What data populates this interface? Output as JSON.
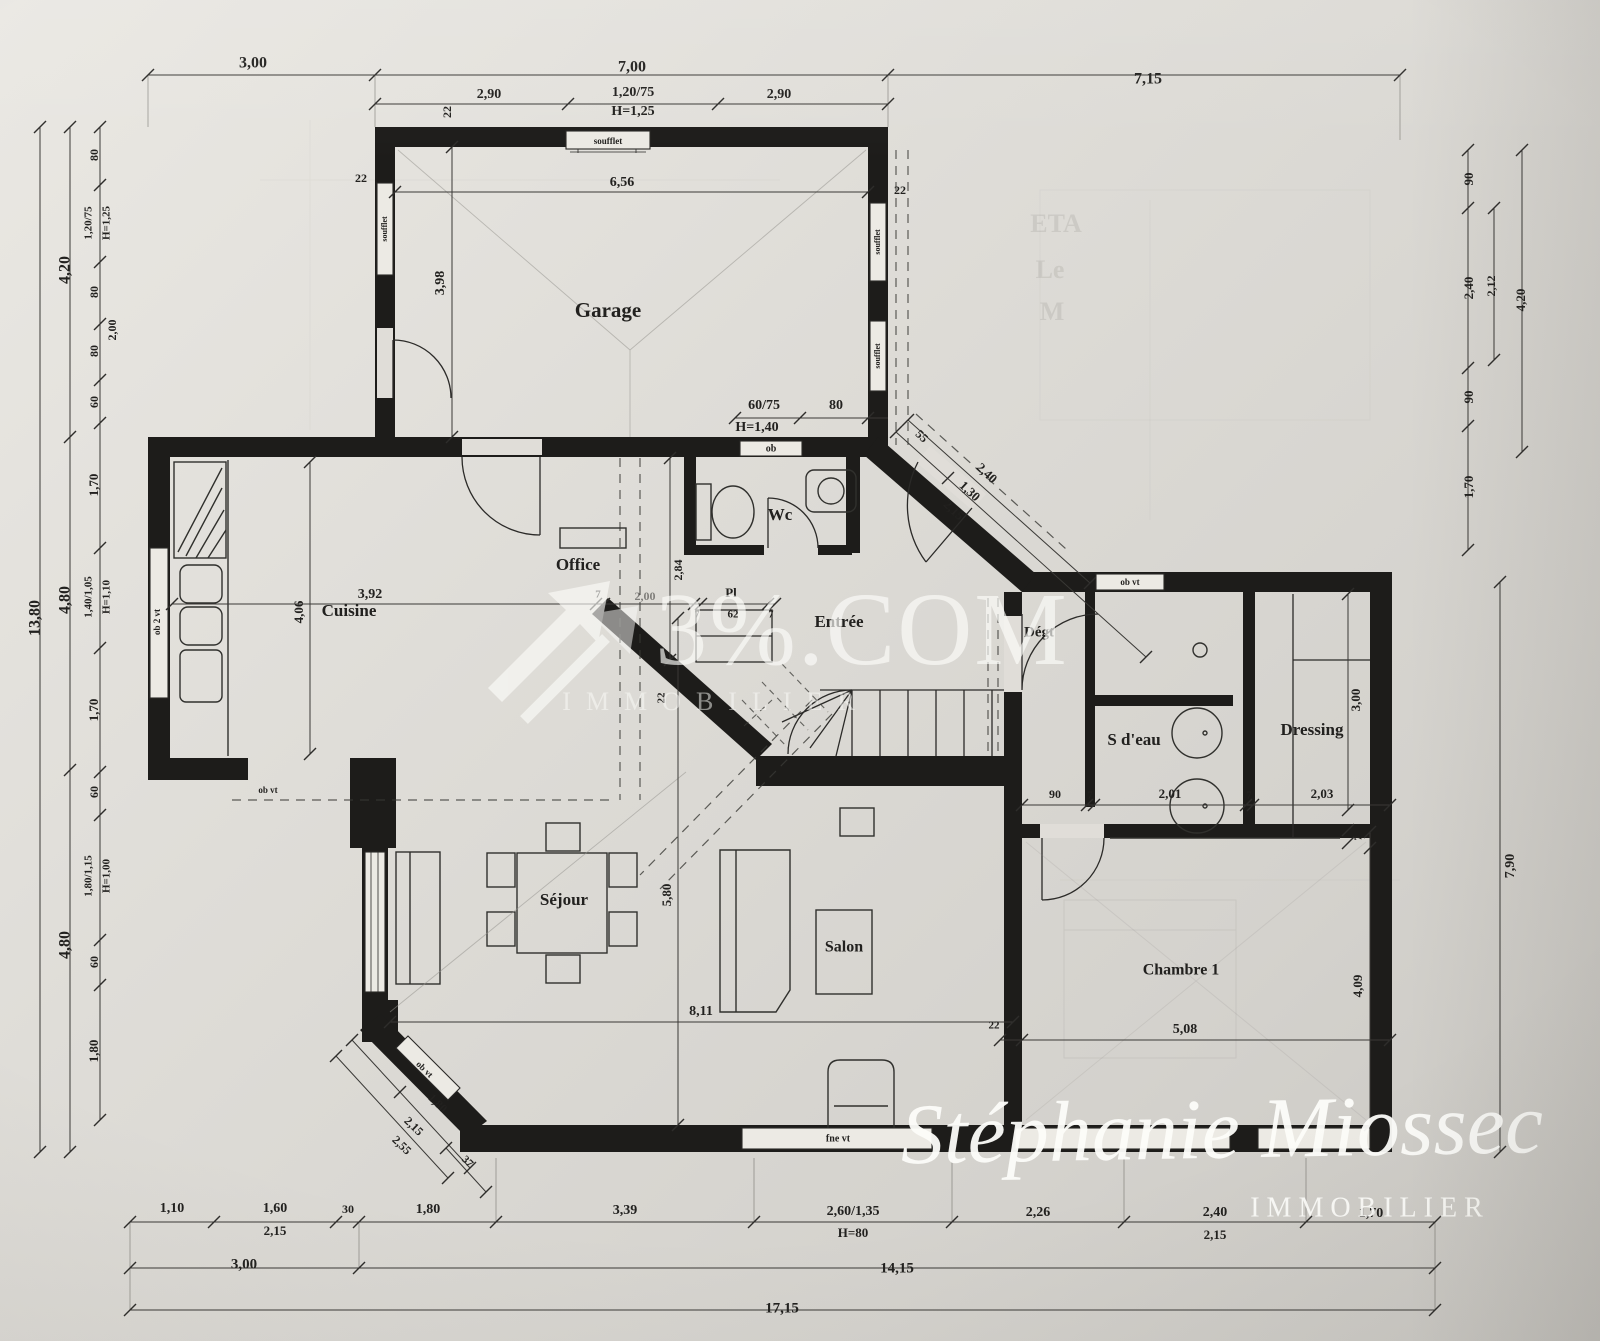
{
  "document": {
    "type": "architectural floor plan",
    "language": "fr"
  },
  "watermark": {
    "brand": "3%.COM",
    "brand_tagline": "IMMOBILIER",
    "brand_logo": "diagonal-arrows-logo",
    "agency": "Stéphanie Miossec",
    "agency_tagline": "IMMOBILIER"
  },
  "labels": {
    "rooms": [
      {
        "t": "Garage",
        "x": 608,
        "y": 312,
        "s": 21
      },
      {
        "t": "Office",
        "x": 578,
        "y": 566,
        "s": 17
      },
      {
        "t": "Cuisine",
        "x": 349,
        "y": 612,
        "s": 17
      },
      {
        "t": "Wc",
        "x": 780,
        "y": 516,
        "s": 17
      },
      {
        "t": "Entrée",
        "x": 839,
        "y": 623,
        "s": 17
      },
      {
        "t": "Dégt",
        "x": 1039,
        "y": 633,
        "s": 15
      },
      {
        "t": "Pl",
        "x": 731,
        "y": 594,
        "s": 13
      },
      {
        "t": "S d'eau",
        "x": 1134,
        "y": 741,
        "s": 17
      },
      {
        "t": "Dressing",
        "x": 1312,
        "y": 731,
        "s": 17
      },
      {
        "t": "Séjour",
        "x": 564,
        "y": 901,
        "s": 17
      },
      {
        "t": "Salon",
        "x": 844,
        "y": 948,
        "s": 16
      },
      {
        "t": "Chambre 1",
        "x": 1181,
        "y": 971,
        "s": 16
      }
    ],
    "windows": [
      {
        "t": "soufflet",
        "x": 608,
        "y": 142,
        "s": 9
      },
      {
        "t": "soufflet",
        "x": 385,
        "y": 229,
        "r": -90,
        "s": 8
      },
      {
        "t": "soufflet",
        "x": 878,
        "y": 242,
        "r": -90,
        "s": 8
      },
      {
        "t": "soufflet",
        "x": 878,
        "y": 356,
        "r": -90,
        "s": 8
      },
      {
        "t": "ob",
        "x": 771,
        "y": 449,
        "s": 10
      },
      {
        "t": "ob vt",
        "x": 1130,
        "y": 583,
        "s": 9
      },
      {
        "t": "ob vt",
        "x": 268,
        "y": 791,
        "s": 9
      },
      {
        "t": "ob 2 vt",
        "x": 158,
        "y": 622,
        "r": -90,
        "s": 9
      },
      {
        "t": "fne vt",
        "x": 838,
        "y": 1139,
        "s": 10
      },
      {
        "t": "ob vt",
        "x": 424,
        "y": 1070,
        "r": 44,
        "s": 9
      }
    ],
    "dims": [
      {
        "t": "3,00",
        "x": 253,
        "y": 64,
        "s": 16
      },
      {
        "t": "7,00",
        "x": 632,
        "y": 68,
        "s": 16
      },
      {
        "t": "7,15",
        "x": 1148,
        "y": 80,
        "s": 16
      },
      {
        "t": "2,90",
        "x": 489,
        "y": 95,
        "s": 14
      },
      {
        "t": "1,20/75",
        "x": 633,
        "y": 93,
        "s": 14
      },
      {
        "t": "H=1,25",
        "x": 633,
        "y": 112,
        "s": 14
      },
      {
        "t": "2,90",
        "x": 779,
        "y": 95,
        "s": 14
      },
      {
        "t": "22",
        "x": 448,
        "y": 112,
        "r": -90,
        "s": 12
      },
      {
        "t": "22",
        "x": 361,
        "y": 179,
        "s": 12
      },
      {
        "t": "6,56",
        "x": 622,
        "y": 183,
        "s": 14
      },
      {
        "t": "22",
        "x": 900,
        "y": 191,
        "s": 12
      },
      {
        "t": "3,98",
        "x": 441,
        "y": 283,
        "r": -90,
        "s": 14
      },
      {
        "t": "60/75",
        "x": 764,
        "y": 406,
        "s": 14
      },
      {
        "t": "H=1,40",
        "x": 757,
        "y": 428,
        "s": 14
      },
      {
        "t": "80",
        "x": 836,
        "y": 406,
        "s": 14
      },
      {
        "t": "55",
        "x": 921,
        "y": 437,
        "r": 43,
        "s": 12
      },
      {
        "t": "2,40",
        "x": 986,
        "y": 474,
        "r": 43,
        "s": 13
      },
      {
        "t": "1,30",
        "x": 969,
        "y": 492,
        "r": 43,
        "s": 13
      },
      {
        "t": "2,15",
        "x": 953,
        "y": 511,
        "r": 43,
        "s": 13
      },
      {
        "t": "13,80",
        "x": 36,
        "y": 618,
        "r": -90,
        "s": 16
      },
      {
        "t": "4,20",
        "x": 66,
        "y": 270,
        "r": -90,
        "s": 16
      },
      {
        "t": "4,80",
        "x": 66,
        "y": 600,
        "r": -90,
        "s": 16
      },
      {
        "t": "4,80",
        "x": 66,
        "y": 945,
        "r": -90,
        "s": 16
      },
      {
        "t": "80",
        "x": 95,
        "y": 155,
        "r": -90,
        "s": 12
      },
      {
        "t": "1,20/75",
        "x": 89,
        "y": 223,
        "r": -90,
        "s": 11
      },
      {
        "t": "H=1,25",
        "x": 107,
        "y": 223,
        "r": -90,
        "s": 11
      },
      {
        "t": "80",
        "x": 95,
        "y": 292,
        "r": -90,
        "s": 12
      },
      {
        "t": "80",
        "x": 95,
        "y": 351,
        "r": -90,
        "s": 12
      },
      {
        "t": "2,00",
        "x": 113,
        "y": 330,
        "r": -90,
        "s": 12
      },
      {
        "t": "60",
        "x": 95,
        "y": 402,
        "r": -90,
        "s": 12
      },
      {
        "t": "1,70",
        "x": 95,
        "y": 485,
        "r": -90,
        "s": 13
      },
      {
        "t": "1,40/1,05",
        "x": 89,
        "y": 597,
        "r": -90,
        "s": 11
      },
      {
        "t": "H=1,10",
        "x": 107,
        "y": 597,
        "r": -90,
        "s": 11
      },
      {
        "t": "1,70",
        "x": 95,
        "y": 710,
        "r": -90,
        "s": 13
      },
      {
        "t": "60",
        "x": 95,
        "y": 792,
        "r": -90,
        "s": 12
      },
      {
        "t": "1,80/1,15",
        "x": 89,
        "y": 876,
        "r": -90,
        "s": 11
      },
      {
        "t": "H=1,00",
        "x": 107,
        "y": 876,
        "r": -90,
        "s": 11
      },
      {
        "t": "60",
        "x": 95,
        "y": 962,
        "r": -90,
        "s": 12
      },
      {
        "t": "1,80",
        "x": 95,
        "y": 1051,
        "r": -90,
        "s": 13
      },
      {
        "t": "90",
        "x": 1470,
        "y": 179,
        "r": -90,
        "s": 13
      },
      {
        "t": "2,40",
        "x": 1470,
        "y": 288,
        "r": -90,
        "s": 13
      },
      {
        "t": "2,12",
        "x": 1492,
        "y": 286,
        "r": -90,
        "s": 12
      },
      {
        "t": "4,20",
        "x": 1522,
        "y": 300,
        "r": -90,
        "s": 13
      },
      {
        "t": "90",
        "x": 1470,
        "y": 397,
        "r": -90,
        "s": 13
      },
      {
        "t": "1,70",
        "x": 1470,
        "y": 487,
        "r": -90,
        "s": 13
      },
      {
        "t": "7,90",
        "x": 1511,
        "y": 866,
        "r": -90,
        "s": 14
      },
      {
        "t": "3,00",
        "x": 1357,
        "y": 700,
        "r": -90,
        "s": 13
      },
      {
        "t": "7",
        "x": 1359,
        "y": 838,
        "r": -90,
        "s": 10
      },
      {
        "t": "4,09",
        "x": 1359,
        "y": 986,
        "r": -90,
        "s": 13
      },
      {
        "t": "3,92",
        "x": 370,
        "y": 595,
        "s": 14
      },
      {
        "t": "4,06",
        "x": 300,
        "y": 612,
        "r": -90,
        "s": 13
      },
      {
        "t": "7",
        "x": 598,
        "y": 595,
        "s": 11
      },
      {
        "t": "2,00",
        "x": 645,
        "y": 597,
        "s": 12,
        "o": 0.5
      },
      {
        "t": "2,84",
        "x": 679,
        "y": 570,
        "r": -90,
        "s": 12
      },
      {
        "t": "7",
        "x": 697,
        "y": 615,
        "s": 10
      },
      {
        "t": "62",
        "x": 733,
        "y": 615,
        "s": 11
      },
      {
        "t": "7",
        "x": 771,
        "y": 615,
        "s": 10
      },
      {
        "t": "22",
        "x": 662,
        "y": 698,
        "r": -90,
        "s": 11
      },
      {
        "t": "90",
        "x": 1055,
        "y": 795,
        "s": 12
      },
      {
        "t": "7",
        "x": 1090,
        "y": 796,
        "s": 10
      },
      {
        "t": "2,01",
        "x": 1170,
        "y": 795,
        "s": 13
      },
      {
        "t": "7",
        "x": 1249,
        "y": 796,
        "s": 10
      },
      {
        "t": "2,03",
        "x": 1322,
        "y": 795,
        "s": 13
      },
      {
        "t": "5,80",
        "x": 668,
        "y": 895,
        "r": -90,
        "s": 13
      },
      {
        "t": "8,11",
        "x": 701,
        "y": 1012,
        "s": 14
      },
      {
        "t": "22",
        "x": 994,
        "y": 1026,
        "s": 11
      },
      {
        "t": "5,08",
        "x": 1185,
        "y": 1030,
        "s": 14
      },
      {
        "t": "1,80",
        "x": 437,
        "y": 1104,
        "r": 44,
        "s": 12
      },
      {
        "t": "2,15",
        "x": 413,
        "y": 1127,
        "r": 44,
        "s": 12
      },
      {
        "t": "2,55",
        "x": 401,
        "y": 1146,
        "r": 44,
        "s": 12
      },
      {
        "t": "37",
        "x": 467,
        "y": 1162,
        "r": 44,
        "s": 11
      },
      {
        "t": "1,10",
        "x": 172,
        "y": 1209,
        "s": 14
      },
      {
        "t": "1,60",
        "x": 275,
        "y": 1209,
        "s": 14
      },
      {
        "t": "2,15",
        "x": 275,
        "y": 1232,
        "s": 13
      },
      {
        "t": "30",
        "x": 348,
        "y": 1210,
        "s": 12
      },
      {
        "t": "1,80",
        "x": 428,
        "y": 1210,
        "s": 14
      },
      {
        "t": "3,39",
        "x": 625,
        "y": 1211,
        "s": 14
      },
      {
        "t": "2,60/1,35",
        "x": 853,
        "y": 1212,
        "s": 14
      },
      {
        "t": "H=80",
        "x": 853,
        "y": 1234,
        "s": 13
      },
      {
        "t": "2,26",
        "x": 1038,
        "y": 1213,
        "s": 14
      },
      {
        "t": "2,40",
        "x": 1215,
        "y": 1213,
        "s": 14
      },
      {
        "t": "2,15",
        "x": 1215,
        "y": 1236,
        "s": 13
      },
      {
        "t": "1,70",
        "x": 1371,
        "y": 1214,
        "s": 14
      },
      {
        "t": "3,00",
        "x": 244,
        "y": 1265,
        "s": 15
      },
      {
        "t": "14,15",
        "x": 897,
        "y": 1269,
        "s": 15
      },
      {
        "t": "17,15",
        "x": 782,
        "y": 1309,
        "s": 15
      }
    ],
    "ghost": [
      {
        "t": "ETA",
        "x": 1056,
        "y": 226,
        "s": 26
      },
      {
        "t": "Le",
        "x": 1050,
        "y": 272,
        "s": 26
      },
      {
        "t": "M",
        "x": 1052,
        "y": 314,
        "s": 26
      }
    ]
  }
}
